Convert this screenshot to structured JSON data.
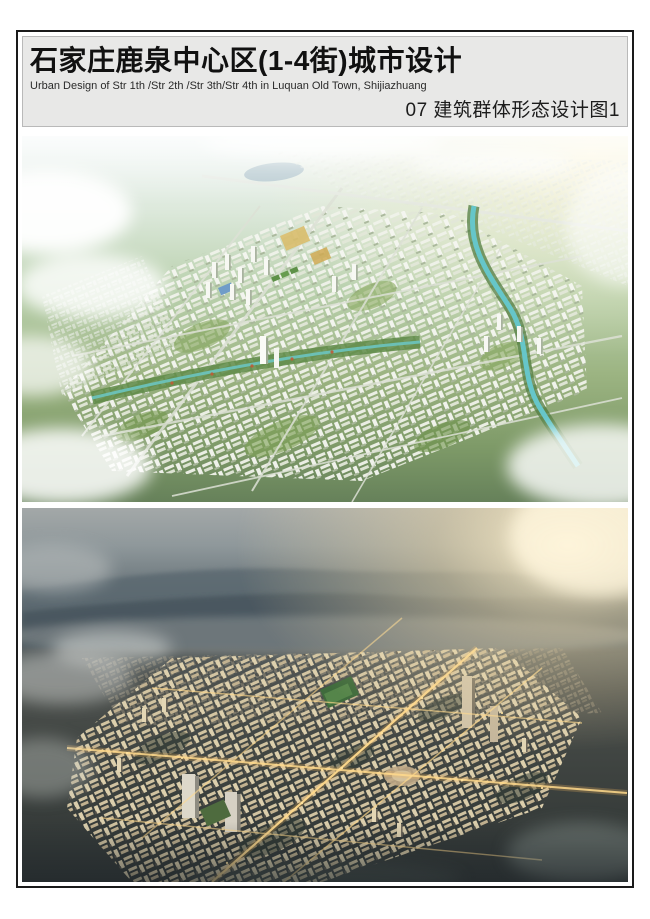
{
  "header": {
    "title": "石家庄鹿泉中心区(1-4街)城市设计",
    "subtitle": "Urban Design of Str 1th /Str 2th /Str 3th/Str 4th  in Luquan Old Town, Shijiazhuang",
    "section_label": "07 建筑群体形态设计图1"
  },
  "palette": {
    "page_background": "#ffffff",
    "frame_border": "#1a1a1a",
    "header_background": "#e8e8e7",
    "header_border": "#b9b9b9",
    "title_color": "#111111",
    "day_render_sky_haze": "#edf4f3",
    "day_render_greenery": "#9cb482",
    "day_render_river": "#66c6c9",
    "day_render_buildings": "#f0f2ea",
    "dusk_render_sky": "#9fa5a6",
    "dusk_render_mountains": "#49565e",
    "dusk_render_sun_glow": "#fff3d2",
    "dusk_render_buildings": "#d9caa6",
    "dusk_render_street_lights": "#ffd98c"
  }
}
